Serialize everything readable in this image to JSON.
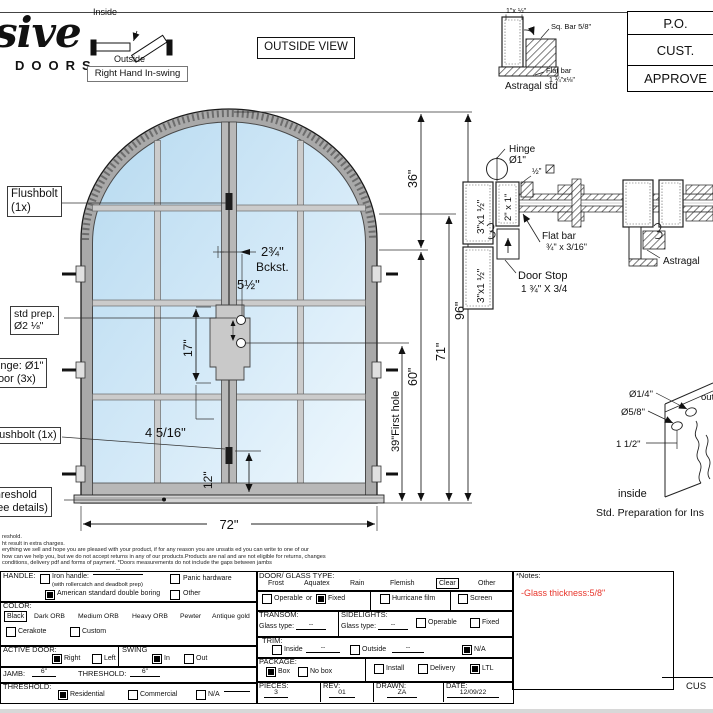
{
  "branding": {
    "script": "sive",
    "word": "DOORS"
  },
  "swing_diagram": {
    "inside": "Inside",
    "outside": "Outside",
    "caption": "Right Hand In-swing"
  },
  "view_label": "OUTSIDE VIEW",
  "astragal_detail": {
    "tube_dim": "1\"x ½\"",
    "sq_bar": "Sq. Bar 5/8\"",
    "flat_bar": "Flat bar",
    "flat_bar_dim": "1 ¾\"x⅛\"",
    "caption": "Astragal std"
  },
  "approval": {
    "rows": [
      "P.O.",
      "CUST.",
      "APPROVE"
    ]
  },
  "door_labels": {
    "flushbolt_top_1": "Flushbolt",
    "flushbolt_top_2": "(1x)",
    "std_prep_1": "std prep.",
    "std_prep_2": "Ø2 ⅛\"",
    "hinge_1": "Hinge: Ø1\"",
    "hinge_2": "Door (3x)",
    "flushbolt_bottom": "Flushbolt (1x)",
    "threshold_1": "Threshold",
    "threshold_2": "(see details)"
  },
  "dims": {
    "w": "72\"",
    "h96": "96\"",
    "h71": "71\"",
    "h60": "60\"",
    "h36": "36\"",
    "first_hole": "39\"First hole",
    "backset": "2¾\"",
    "backset_label": "Bckst.",
    "hole_spacing": "5½\"",
    "lock_height": "17\"",
    "stile": "4 5/16\"",
    "bottom": "12\""
  },
  "section": {
    "jamb_profile": "3\"x1 ½\"",
    "jamb_profile2": "3\"x1 ½\"",
    "tube": "2\" x 1\"",
    "hinge_label_1": "Hinge",
    "hinge_label_2": "Ø1\"",
    "half_bar": "½\"",
    "flat_bar_1": "Flat bar",
    "flat_bar_2": "¾\" x 3/16\"",
    "door_stop_1": "Door Stop",
    "door_stop_2": "1 ¾\" X 3/4",
    "astragal": "Astragal"
  },
  "prep": {
    "d1": "Ø1/4\"",
    "d2": "Ø5/8\"",
    "d3": "1 1/2\"",
    "inside": "inside",
    "outside": "outside",
    "caption": "Std. Preparation for Ins"
  },
  "disclaimer": [
    "reshold.",
    "ht result in extra charges.",
    "erything we sell and hope you are pleased with your product, if for any reason you are unsatis ed you can write to one of our",
    "how can we help you, but we do not accept returns in any of our products.Products are nal and are not eligible for returns, changes",
    "conditions, delivery pdf and forms of payment. *Doors measurements do not include the gaps between jambs"
  ],
  "form": {
    "handle": {
      "label": "HANDLE:",
      "iron": {
        "checked": "false",
        "label": "Iron handle:",
        "value": "--",
        "sub": "(with rollercatch and deadbolt prep)"
      },
      "panic": {
        "checked": "false",
        "label": "Panic hardware"
      },
      "american": {
        "checked": "true",
        "label": "American standard double boring"
      },
      "other": {
        "checked": "false",
        "label": "Other"
      }
    },
    "color": {
      "label": "COLOR:",
      "selected": "Black",
      "opt1": "Dark ORB",
      "opt2": "Medium ORB",
      "opt3": "Heavy ORB",
      "opt4": "Pewter",
      "opt5": "Antique gold",
      "cerakote": {
        "checked": "false",
        "label": "Cerakote"
      },
      "custom": {
        "checked": "false",
        "label": "Custom"
      }
    },
    "active_door": {
      "label": "ACTIVE DOOR:",
      "right": {
        "checked": "true",
        "label": "Right"
      },
      "left": {
        "checked": "false",
        "label": "Left"
      }
    },
    "swing": {
      "label": "SWING",
      "in": {
        "checked": "true",
        "label": "In"
      },
      "out": {
        "checked": "false",
        "label": "Out"
      }
    },
    "jamb": {
      "label": "JAMB:",
      "value": "6\""
    },
    "threshold_size": {
      "label": "THRESHOLD:",
      "value": "6\""
    },
    "threshold": {
      "label": "THRESHOLD:",
      "residential": {
        "checked": "true",
        "label": "Residential"
      },
      "commercial": {
        "checked": "false",
        "label": "Commercial"
      },
      "na": {
        "checked": "false",
        "label": "N/A"
      }
    },
    "glass_type": {
      "label": "DOOR/ GLASS TYPE:",
      "opt1": "Frost",
      "opt2": "Aquatex",
      "opt3": "Rain",
      "opt4": "Flemish",
      "selected": "Clear",
      "other": "Other"
    },
    "operable_row": {
      "operable": {
        "checked": "false",
        "label": "Operable"
      },
      "or": "or",
      "fixed": {
        "checked": "true",
        "label": "Fixed"
      },
      "hurricane": {
        "checked": "false",
        "label": "Hurricane film"
      },
      "screen": {
        "checked": "false",
        "label": "Screen"
      }
    },
    "transom": {
      "label": "TRANSOM:",
      "glass_label": "Glass type:",
      "value": "--"
    },
    "sidelights": {
      "label": "SIDELIGHTS:",
      "glass_label": "Glass type:",
      "value": "--",
      "operable": {
        "checked": "false",
        "label": "Operable"
      },
      "fixed": {
        "checked": "false",
        "label": "Fixed"
      }
    },
    "trim": {
      "label": "TRIM:",
      "inside": {
        "checked": "false",
        "label": "Inside",
        "value": "--"
      },
      "outside": {
        "checked": "false",
        "label": "Outside",
        "value": "--"
      },
      "na": {
        "checked": "true",
        "label": "N/A"
      }
    },
    "package": {
      "label": "PACKAGE:",
      "box": {
        "checked": "true",
        "label": "Box"
      },
      "nobox": {
        "checked": "false",
        "label": "No box"
      },
      "install": {
        "checked": "false",
        "label": "Install"
      },
      "delivery": {
        "checked": "false",
        "label": "Delivery"
      },
      "ltl": {
        "checked": "true",
        "label": "LTL"
      }
    },
    "pieces": {
      "label": "PIECES:",
      "value": "3"
    },
    "rev": {
      "label": "REV:",
      "value": "01"
    },
    "drawn": {
      "label": "DRAWN:",
      "value": "ZA"
    },
    "date": {
      "label": "DATE:",
      "value": "12/09/22"
    }
  },
  "notes": {
    "title": "*Notes:",
    "line1": "-Glass thickness:5/8\"",
    "color": "#e8352b"
  },
  "footer": {
    "cus": "CUS"
  }
}
